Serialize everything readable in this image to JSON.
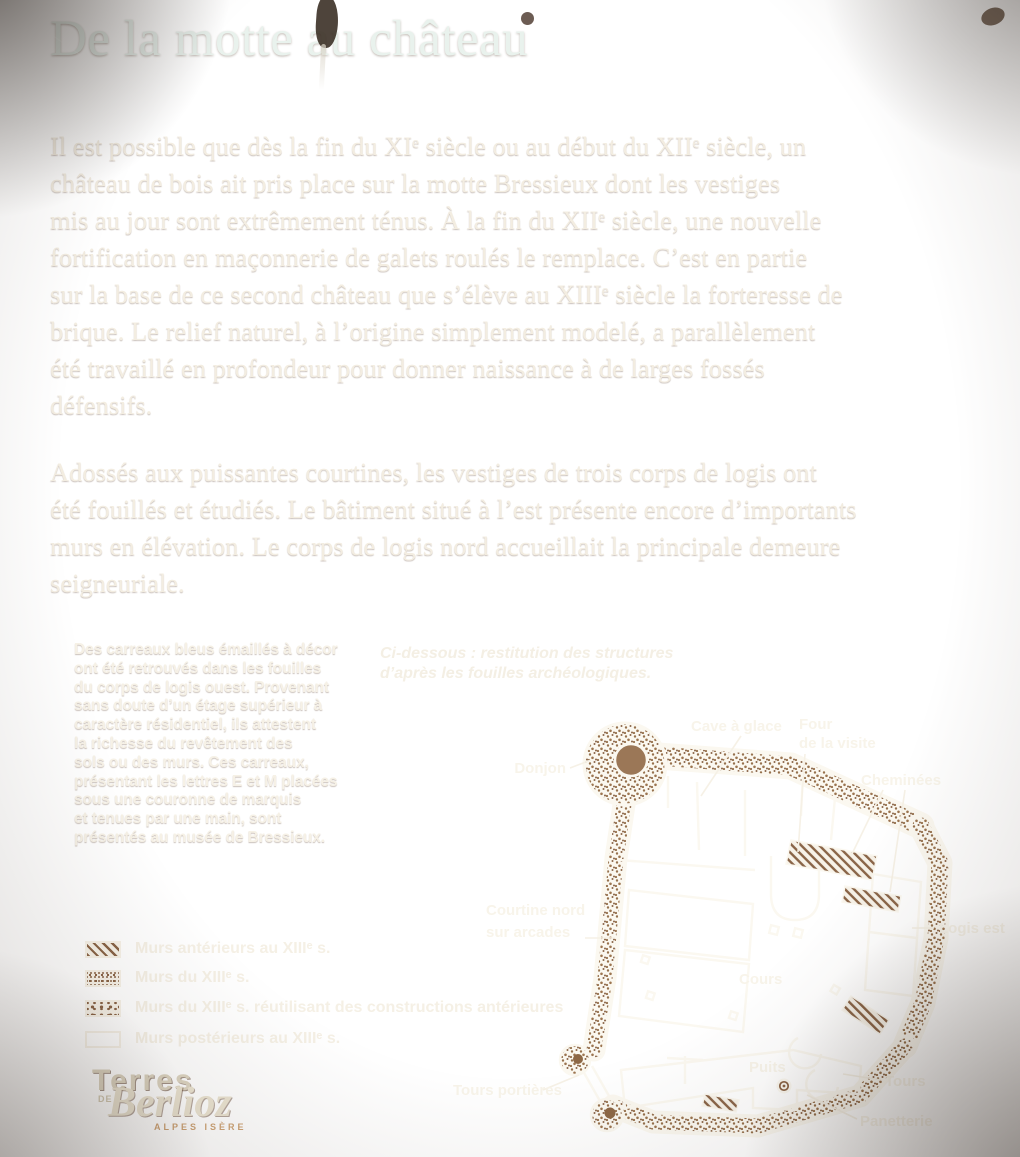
{
  "panel": {
    "title": "De la motte au château",
    "paragraph1": "Il est possible que dès la fin du XIᵉ siècle ou au début du XIIᵉ siècle, un\nchâteau de bois ait pris place sur la motte Bressieux dont les vestiges\nmis au jour sont extrêmement ténus. À la fin du XIIᵉ siècle, une nouvelle\nfortification en maçonnerie de galets roulés le remplace. C’est en partie\nsur la base de ce second château que s’élève au XIIIᵉ siècle la forteresse de\nbrique. Le relief naturel, à l’origine simplement modelé, a parallèlement\nété travaillé en profondeur pour donner naissance à de larges fossés\ndéfensifs.",
    "paragraph2": "Adossés aux puissantes courtines, les vestiges de trois corps de logis ont\nété fouillés et étudiés. Le bâtiment situé à l’est présente encore d’importants\nmurs en élévation. Le corps de logis nord accueillait la principale demeure\nseigneuriale.",
    "sidebar_note": "Des carreaux bleus émaillés à décor\nont été retrouvés dans les fouilles\ndu corps de logis ouest. Provenant\nsans doute d’un étage supérieur à\ncaractère résidentiel, ils attestent\nla richesse du revêtement des\nsols ou des murs. Ces carreaux,\nprésentant les lettres E et M placées\nsous une couronne de marquis\net tenues par une main, sont\nprésentés au musée de Bressieux.",
    "plan_caption": "Ci-dessous : restitution des structures\nd’après les fouilles archéologiques."
  },
  "legend": {
    "items": [
      {
        "swatch": "hatch",
        "label": "Murs antérieurs au XIIIᵉ s."
      },
      {
        "swatch": "stipple-fine",
        "label": "Murs du XIIIᵉ s."
      },
      {
        "swatch": "stipple-coarse",
        "label": "Murs du XIIIᵉ s. réutilisant des constructions antérieures"
      },
      {
        "swatch": "outline",
        "label": "Murs postérieurs au XIIIᵉ s."
      }
    ]
  },
  "plan": {
    "labels": {
      "donjon": "Donjon",
      "cave_a_glace": "Cave à glace",
      "four_line1": "Four",
      "four_line2": "de la visite",
      "cheminees": "Cheminées",
      "courtine_line1": "Courtine nord",
      "courtine_line2": "sur arcades",
      "logis_est": "Logis est",
      "cours": "Cours",
      "puits": "Puits",
      "tours": "Tours",
      "tours_portieres": "Tours portières",
      "panetterie": "Panetterie"
    }
  },
  "logo": {
    "line1": "Terres",
    "de": "DE",
    "line2": "Berlioz",
    "line3": "ALPES ISÈRE"
  },
  "colors": {
    "background_brown": "#8f6a49",
    "title_text": "#e9f2ed",
    "body_text": "#f3ede1",
    "plan_line": "#fbf8f0",
    "wall_dot": "#8a6548"
  }
}
